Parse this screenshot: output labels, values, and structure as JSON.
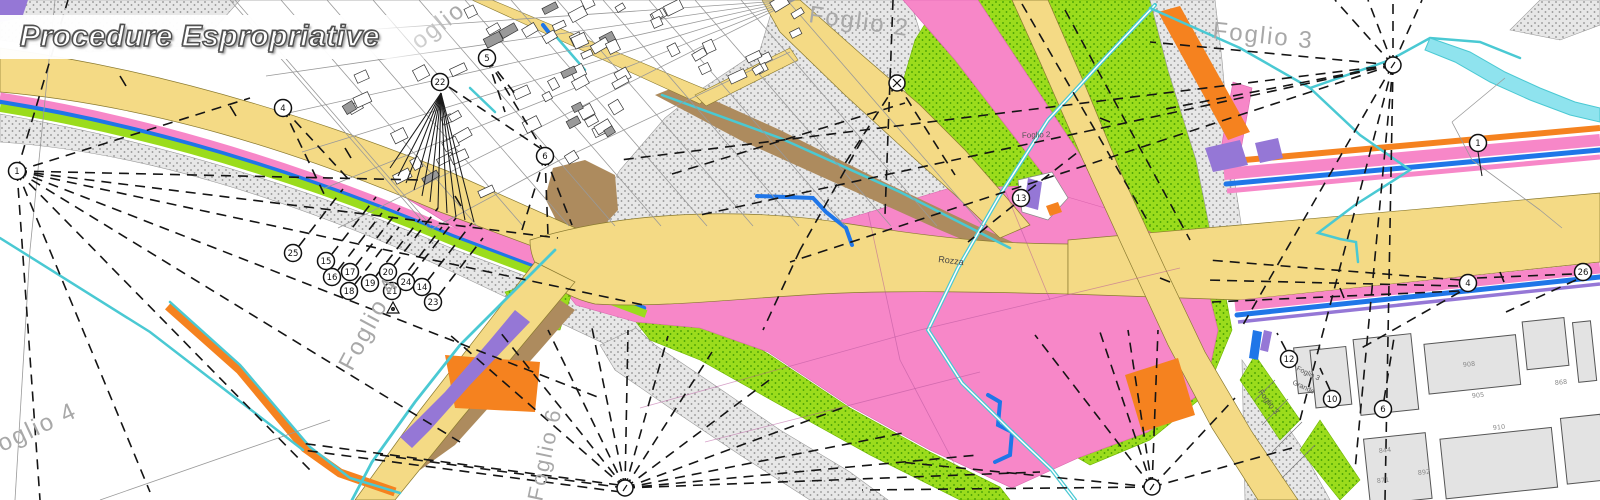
{
  "title": {
    "text": "Procedure Espropriative"
  },
  "map": {
    "type": "cadastral-expropriation-plan",
    "sheet_labels": [
      {
        "text": "oglio",
        "x": 419,
        "y": 50,
        "rot": -38,
        "size": 24,
        "cls": "sheet-label"
      },
      {
        "text": "Foglio 2",
        "x": 808,
        "y": 22,
        "rot": 8,
        "size": 24,
        "cls": "sheet-label"
      },
      {
        "text": "Foglio 3",
        "x": 1212,
        "y": 38,
        "rot": 6,
        "size": 24,
        "cls": "sheet-label"
      },
      {
        "text": "Foglio 4",
        "x": 352,
        "y": 372,
        "rot": -62,
        "size": 24,
        "cls": "sheet-label"
      },
      {
        "text": "oglio 4",
        "x": 2,
        "y": 452,
        "rot": -25,
        "size": 24,
        "cls": "sheet-label"
      },
      {
        "text": "Foglio 6",
        "x": 542,
        "y": 502,
        "rot": -78,
        "size": 22,
        "cls": "sheet-label"
      },
      {
        "text": "Foglio 2",
        "x": 1022,
        "y": 138,
        "rot": -2,
        "size": 8,
        "cls": "small-label"
      },
      {
        "text": "Foglio 3",
        "x": 1258,
        "y": 392,
        "rot": 53,
        "size": 8,
        "cls": "small-label"
      },
      {
        "text": "Foglio 3",
        "x": 1296,
        "y": 370,
        "rot": 25,
        "size": 7,
        "cls": "small-label"
      },
      {
        "text": "Grande",
        "x": 1292,
        "y": 384,
        "rot": 25,
        "size": 7,
        "cls": "small-label"
      }
    ],
    "road_labels": [
      {
        "text": "Rozza",
        "x": 938,
        "y": 262,
        "rot": 7,
        "size": 9
      }
    ],
    "station_markers": [
      {
        "n": "1",
        "x": 17,
        "y": 171,
        "type": "c"
      },
      {
        "n": "4",
        "x": 283,
        "y": 108,
        "type": "c"
      },
      {
        "n": "22",
        "x": 440,
        "y": 82,
        "type": "c"
      },
      {
        "n": "5",
        "x": 487,
        "y": 58,
        "type": "c"
      },
      {
        "n": "6",
        "x": 545,
        "y": 156,
        "type": "c"
      },
      {
        "n": "25",
        "x": 293,
        "y": 253,
        "type": "c"
      },
      {
        "n": "15",
        "x": 326,
        "y": 261,
        "type": "c"
      },
      {
        "n": "16",
        "x": 332,
        "y": 277,
        "type": "c"
      },
      {
        "n": "17",
        "x": 350,
        "y": 272,
        "type": "c"
      },
      {
        "n": "18",
        "x": 349,
        "y": 291,
        "type": "c"
      },
      {
        "n": "19",
        "x": 370,
        "y": 283,
        "type": "c"
      },
      {
        "n": "20",
        "x": 388,
        "y": 272,
        "type": "c"
      },
      {
        "n": "21",
        "x": 392,
        "y": 291,
        "type": "c"
      },
      {
        "n": "24",
        "x": 406,
        "y": 282,
        "type": "c"
      },
      {
        "n": "14",
        "x": 422,
        "y": 287,
        "type": "c"
      },
      {
        "n": "23",
        "x": 433,
        "y": 302,
        "type": "c"
      },
      {
        "n": "13",
        "x": 1021,
        "y": 198,
        "type": "c"
      },
      {
        "n": "1",
        "x": 1478,
        "y": 143,
        "type": "c"
      },
      {
        "n": "4",
        "x": 1468,
        "y": 283,
        "type": "c"
      },
      {
        "n": "26",
        "x": 1583,
        "y": 272,
        "type": "c"
      },
      {
        "n": "12",
        "x": 1289,
        "y": 359,
        "type": "c"
      },
      {
        "n": "10",
        "x": 1332,
        "y": 399,
        "type": "c"
      },
      {
        "n": "6",
        "x": 1383,
        "y": 409,
        "type": "c"
      },
      {
        "n": "",
        "x": 897,
        "y": 83,
        "type": "x"
      },
      {
        "n": "",
        "x": 1393,
        "y": 65,
        "type": "s"
      },
      {
        "n": "",
        "x": 625,
        "y": 488,
        "type": "s"
      },
      {
        "n": "",
        "x": 1152,
        "y": 487,
        "type": "s"
      },
      {
        "n": "",
        "x": 393,
        "y": 308,
        "type": "t"
      }
    ],
    "parcel_numbers": [
      {
        "t": "908",
        "x": 1463,
        "y": 367
      },
      {
        "t": "905",
        "x": 1472,
        "y": 398
      },
      {
        "t": "910",
        "x": 1493,
        "y": 430
      },
      {
        "t": "844",
        "x": 1379,
        "y": 453
      },
      {
        "t": "892",
        "x": 1418,
        "y": 475
      },
      {
        "t": "871",
        "x": 1377,
        "y": 483
      },
      {
        "t": "868",
        "x": 1555,
        "y": 385
      }
    ],
    "colors": {
      "road_yellow": "#f4da85",
      "zone_pink": "#f787c8",
      "zone_green": "#9bdc1c",
      "zone_orange": "#f5821f",
      "zone_purple": "#9577d6",
      "zone_brown": "#ad8b5e",
      "water_blue": "#1f76e8",
      "channel_cyan": "#4ac9d3",
      "river_fill": "#8fe3ee",
      "label_gray": "#a8a8a8"
    }
  }
}
